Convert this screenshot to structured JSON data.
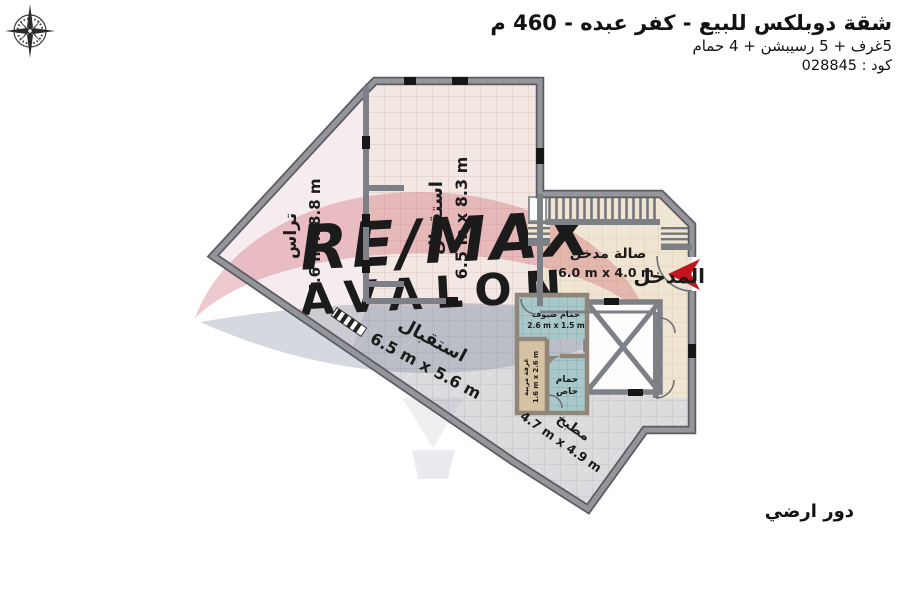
{
  "header": {
    "title": "شقة دوبلكس للبيع - كفر عبده - 460 م",
    "subtitle": "5غرف + 5 رسيبشن + 4 حمام",
    "code": "كود : 028845"
  },
  "footer": {
    "floor_label": "دور ارضي"
  },
  "entrance": {
    "label": "المدخل"
  },
  "watermark": {
    "line1": "RE/MAX",
    "line2": "AVALON"
  },
  "rooms": {
    "terrace": {
      "name": "تراس",
      "dims": "5.6 m x 8.8 m"
    },
    "reception_top": {
      "name": "استقبال",
      "dims": "6.5 m x 8.3 m"
    },
    "reception_mid": {
      "name": "استقبال",
      "dims": "6.5 m x 5.6 m"
    },
    "entrance_hall": {
      "name": "صالة مدخل",
      "dims": "6.0 m x 4.0 m"
    },
    "kitchen": {
      "name": "مطبخ",
      "dims": "4.7 m x 4.9 m"
    },
    "guest_bath": {
      "name": "حمام ضيوف",
      "dims": "2.6 m x 1.5 m"
    },
    "nanny_room": {
      "name": "غرفة مربية",
      "dims": "1.6 m x 2.6 m"
    },
    "private_bath": {
      "name_line1": "حمام",
      "name_line2": "خاص"
    }
  },
  "icons": [
    "compass-icon",
    "entrance-arrow-icon"
  ],
  "colors": {
    "wall": "#7e8087",
    "entrance_arrow_red": "#c3161c",
    "terrace_floor": "#f6ecef",
    "reception_floor": "#f3e7e4",
    "gray_floor": "#dbdbde",
    "hall_floor": "#f0e5d2",
    "bath_floor": "#a9c8ca",
    "nanny_floor": "#d5c2a3",
    "watermark_red": "#c24a55",
    "watermark_gray": "#7d8498",
    "text": "#1b1b1b"
  }
}
